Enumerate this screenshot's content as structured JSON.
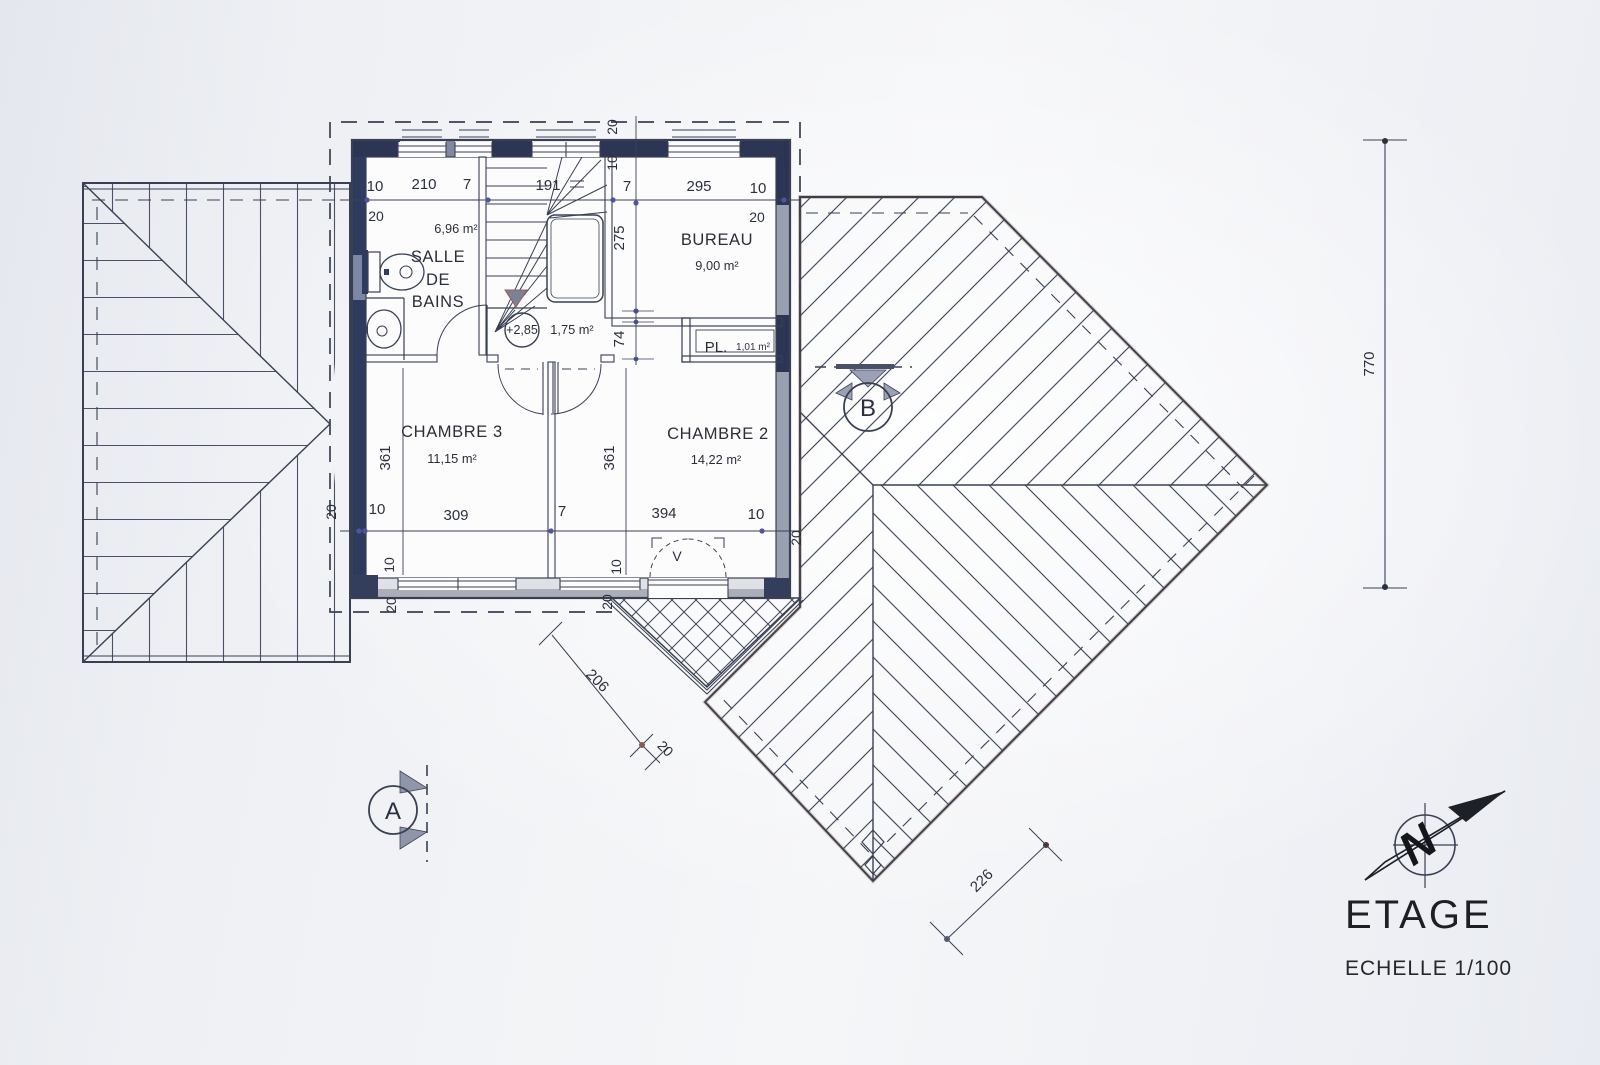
{
  "colors": {
    "paper": "#eef0f4",
    "line": "#3a4054",
    "navy_wall": "#2c3554",
    "grey_wall": "#a6abb7",
    "hatch": "#4a5065",
    "dim_dot": "#5053a0",
    "title_text": "#1d1f24"
  },
  "title": {
    "main": "ETAGE",
    "scale": "ECHELLE 1/100"
  },
  "compass": {
    "letter": "N"
  },
  "markers": {
    "section_a": "A",
    "section_b": "B",
    "level": "+2,85",
    "window_tag": "V"
  },
  "rooms": {
    "salle_de_bains": {
      "line1": "SALLE",
      "line2": "DE",
      "line3": "BAINS",
      "area": "6,96 m²"
    },
    "bureau": {
      "name": "BUREAU",
      "area": "9,00 m²"
    },
    "placard": {
      "name": "PL.",
      "area": "1,01 m²"
    },
    "hall": {
      "area": "1,75 m²"
    },
    "chambre3": {
      "name": "CHAMBRE 3",
      "area": "11,15 m²"
    },
    "chambre2": {
      "name": "CHAMBRE 2",
      "area": "14,22 m²"
    }
  },
  "dims": {
    "top": [
      "10",
      "210",
      "7",
      "191",
      "7",
      "295",
      "10"
    ],
    "top_20_left": "20",
    "top_20_right": "20",
    "top_mid_20": "20",
    "top_mid_10": "10",
    "left_361": "361",
    "mid_275": "275",
    "mid_74": "74",
    "mid_361": "361",
    "bottom": [
      "10",
      "309",
      "7",
      "394",
      "10"
    ],
    "left_20": "20",
    "right_20": "20",
    "bottom_10_left": "10",
    "bottom_10_mid": "10",
    "bottom_20_left": "20",
    "bottom_20_mid": "20",
    "right_770": "770",
    "diag_206": "206",
    "diag_20": "20",
    "diag_226": "226"
  }
}
